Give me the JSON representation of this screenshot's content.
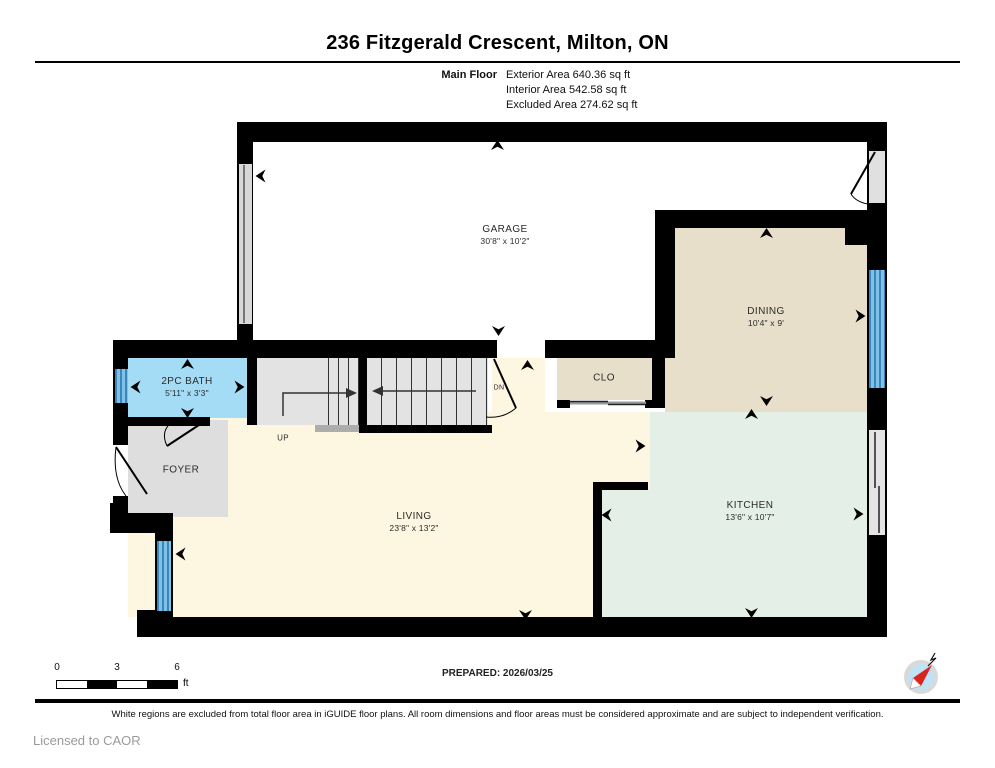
{
  "header": {
    "title": "236 Fitzgerald Crescent, Milton, ON",
    "floor_label": "Main Floor",
    "stats": [
      "Exterior Area 640.36 sq ft",
      "Interior Area 542.58 sq ft",
      "Excluded Area 274.62 sq ft"
    ]
  },
  "rooms": {
    "garage": {
      "name": "GARAGE",
      "dims": "30'8\" x 10'2\""
    },
    "dining": {
      "name": "DINING",
      "dims": "10'4\" x 9'"
    },
    "bath": {
      "name": "2PC BATH",
      "dims": "5'11\" x 3'3\""
    },
    "foyer": {
      "name": "FOYER"
    },
    "living": {
      "name": "LIVING",
      "dims": "23'8\" x 13'2\""
    },
    "kitchen": {
      "name": "KITCHEN",
      "dims": "13'6\" x 10'7\""
    },
    "closet": {
      "name": "CLO"
    },
    "stair_up_label": "UP",
    "stair_down_label": "DN"
  },
  "scale_bar": {
    "ticks": [
      "0",
      "3",
      "6"
    ],
    "unit": "ft"
  },
  "compass": {
    "north_label": "N"
  },
  "prepared_label": "PREPARED: 2026/03/25",
  "footer": {
    "disclaimer": "White regions are excluded from total floor area in iGUIDE floor plans. All room dimensions and floor areas must be considered approximate and are subject to independent verification.",
    "license": "Licensed to CAOR"
  },
  "colors": {
    "wall": "#000000",
    "excluded_white": "#ffffff",
    "living_cream": "#fdf6e1",
    "dining_beige": "#e8dfca",
    "kitchen_green": "#e4efe7",
    "bath_blue": "#a5dcf5",
    "gray_floor": "#e0e0e0",
    "window_blue": "#5aa7d8",
    "compass_blue": "#bfe2f5",
    "compass_needle_red": "#d9251d"
  }
}
